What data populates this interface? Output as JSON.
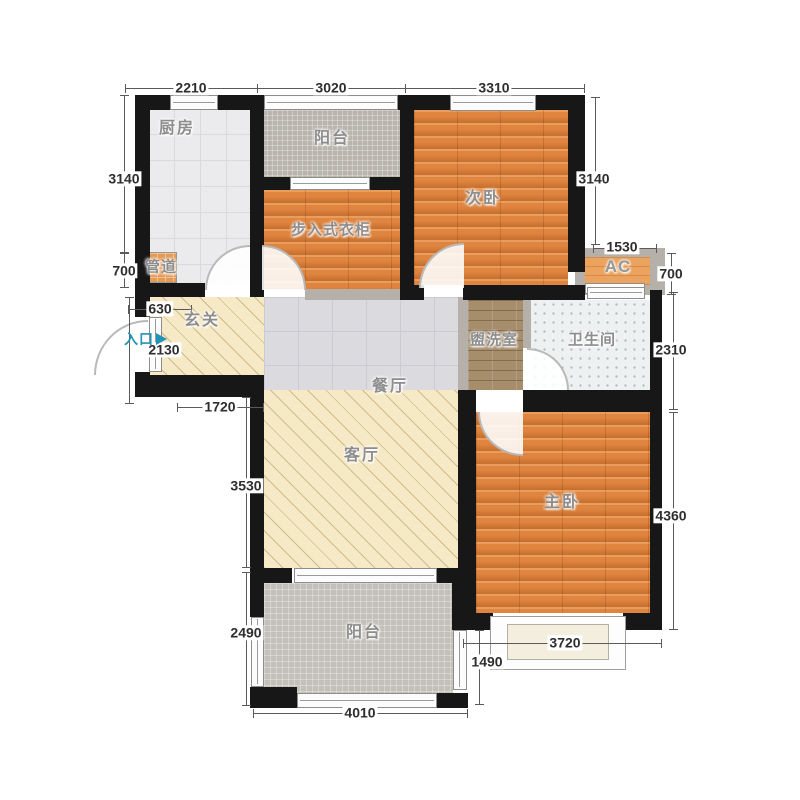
{
  "rooms": {
    "kitchen": "厨房",
    "balcony_top": "阳台",
    "second_bedroom": "次卧",
    "walkin_closet": "步入式衣柜",
    "duct": "管道",
    "ac": "AC",
    "entry_hall": "玄关",
    "entrance": "入口",
    "washroom": "盥洗室",
    "bathroom": "卫生间",
    "dining": "餐厅",
    "living": "客厅",
    "master_bedroom": "主卧",
    "balcony_bottom": "阳台"
  },
  "dims": {
    "top_kitchen": "2210",
    "top_balcony": "3020",
    "top_bedroom": "3310",
    "left_kitchen": "3140",
    "left_duct": "700",
    "entry_door": "630",
    "entry_height": "2130",
    "entry_width": "1720",
    "living_height": "3530",
    "balcony_height": "2490",
    "balcony_width": "4010",
    "balcony_window": "1490",
    "bay_window": "3720",
    "ac_width": "1530",
    "ac_height": "700",
    "right_bedroom": "3140",
    "bath_height": "2310",
    "master_height": "4360"
  },
  "colors": {
    "wall": "#171717",
    "wood_floor": "#df8540",
    "kitchen_tile": "#ebebee",
    "balcony_tile": "#b9b5ad",
    "hall_floor": "#f6e9c6",
    "washroom_floor": "#a68e6c",
    "bathroom_floor": "#eef1f2",
    "entrance_accent": "#2095b5",
    "dimension_text": "#2e2e2e",
    "room_label_text": "#8d8d8d"
  }
}
